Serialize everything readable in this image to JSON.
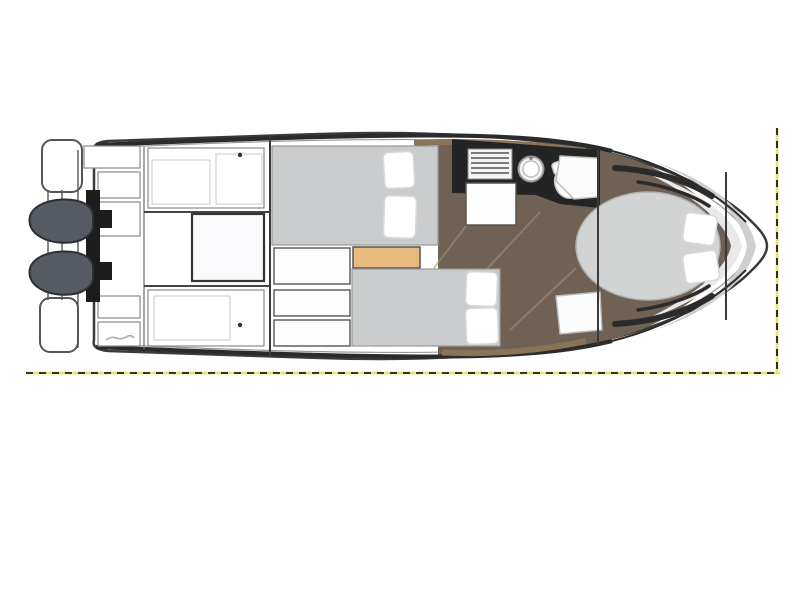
{
  "image_kind": "boat-floorplan-diagram",
  "visible_text": [],
  "legend": [
    "hull",
    "swim-platform",
    "port-engine",
    "starboard-engine",
    "transom-bracket",
    "cockpit-seating",
    "cockpit-table",
    "cockpit-lockers",
    "mid-cabin-double-bed",
    "guest-cabin-double-bed",
    "bow-cabin-island-bed",
    "pillow",
    "steps",
    "bench-seat",
    "galley-counter",
    "galley-stove",
    "galley-sink",
    "toilet",
    "fridge-cabinet",
    "wood-flooring",
    "bow-grab-rail",
    "bow-deck-rim",
    "selection-marquee"
  ],
  "colors": {
    "background": "#ffffff",
    "hull_fill": "#ffffff",
    "hull_outline": "#3a3a3a",
    "deck_trim_dark": "#2b2b2b",
    "wood_floor": "#6f6255",
    "wood_floor_light": "#a2937f",
    "wood_trim": "#8b7357",
    "bed_mattress": "#c9cbcc",
    "bow_bed_mattress": "#d2d4d4",
    "pillow": "#ffffff",
    "pillow_outline": "#d8d8d8",
    "bench_orange": "#e9ba7e",
    "galley_counter": "#242424",
    "engine": "#565b63",
    "engine_outline": "#2c2f35",
    "transom_bracket": "#1c1c1c",
    "furniture_outline": "#555555",
    "faint_outline": "#c8c8c8",
    "bow_deck_silver": "#cfcfcf",
    "bow_deck_silver_light": "#e9e9e9",
    "selection_yellow": "#e6e65a",
    "selection_dash": "#1a1a1a"
  }
}
